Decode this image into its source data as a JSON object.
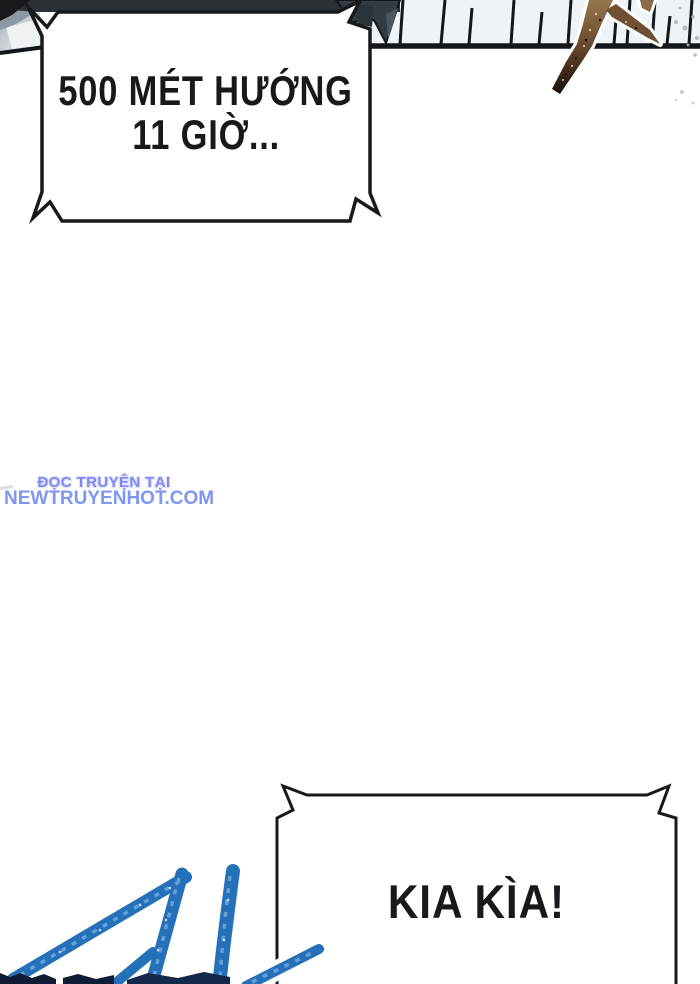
{
  "comic": {
    "bubble_top": {
      "line1": "500 MÉT HƯỚNG",
      "line2": "11 GIỜ..."
    },
    "bubble_bottom": {
      "line1": "KIA KÌA!"
    }
  },
  "watermark": {
    "line1": "ĐỌC TRUYỆN TẠI",
    "line2": "NEWTRUYENHOT.COM"
  },
  "colors": {
    "outline_black": "#17191c",
    "panel_background": "#edf3f6",
    "watermark_title_blue": "#8286f2",
    "watermark_domain_blue": "#7e97f0",
    "crayon_blue": "#2470b9",
    "branch_brown": "#6b4c30",
    "dark_navy_marks": "#101c36"
  },
  "artwork": {
    "top_panel": "wooden-plank-ledge-with-falling-branch",
    "top_left_corner": "gray-snow-roof-slope",
    "bottom_left_sketch": "blue-crayon-number-11"
  }
}
